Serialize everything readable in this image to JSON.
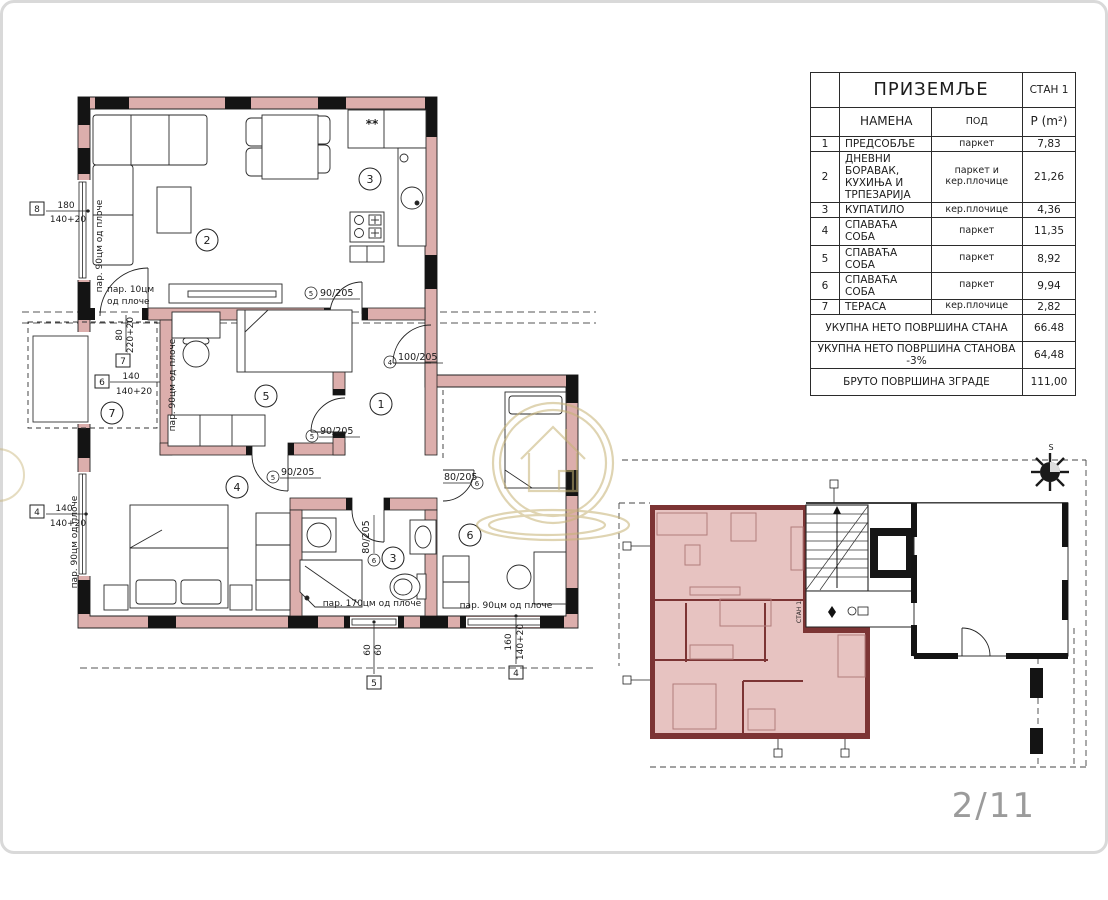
{
  "page": {
    "number": "2/11"
  },
  "table": {
    "title": "ПРИЗЕМЉЕ",
    "unit": "СТАН 1",
    "col_name": "НАМЕНА",
    "col_floor": "ПОД",
    "col_area": "Р (m²)",
    "rows": [
      {
        "num": "1",
        "name": "ПРЕДСОБЉЕ",
        "floor": "паркет",
        "area": "7,83"
      },
      {
        "num": "2",
        "name": "ДНЕВНИ БОРАВАК, КУХИЊА И ТРПЕЗАРИЈА",
        "floor": "паркет и кер.плочице",
        "area": "21,26"
      },
      {
        "num": "3",
        "name": "КУПАТИЛО",
        "floor": "кер.плочице",
        "area": "4,36"
      },
      {
        "num": "4",
        "name": "СПАВАЋА СОБА",
        "floor": "паркет",
        "area": "11,35"
      },
      {
        "num": "5",
        "name": "СПАВАЋА СОБА",
        "floor": "паркет",
        "area": "8,92"
      },
      {
        "num": "6",
        "name": "СПАВАЋА СОБА",
        "floor": "паркет",
        "area": "9,94"
      },
      {
        "num": "7",
        "name": "ТЕРАСА",
        "floor": "кер.плочице",
        "area": "2,82"
      }
    ],
    "summary": [
      {
        "label": "УКУПНА НЕТО ПОВРШИНА СТАНА",
        "value": "66.48"
      },
      {
        "label": "УКУПНА НЕТО ПОВРШИНА СТАНОВА -3%",
        "value": "64,48"
      },
      {
        "label": "БРУТО ПОВРШИНА ЗГРАДЕ",
        "value": "111,00"
      }
    ]
  },
  "floor_plan": {
    "rooms": [
      "1",
      "2",
      "3",
      "3",
      "4",
      "5",
      "6",
      "7"
    ],
    "doors": [
      {
        "size": "90/205",
        "mark": "5"
      },
      {
        "size": "100/205",
        "mark": "4"
      },
      {
        "size": "90/205",
        "mark": "5"
      },
      {
        "size": "90/205",
        "mark": "5"
      },
      {
        "size": "80/205",
        "mark": "6"
      },
      {
        "size": "80/205",
        "mark": "6"
      }
    ],
    "dims": [
      {
        "id": "8",
        "a": "180",
        "b": "140+20"
      },
      {
        "id": "7",
        "a": "80",
        "b": "220+20"
      },
      {
        "id": "6",
        "a": "140",
        "b": "140+20"
      },
      {
        "id": "4",
        "a": "140",
        "b": "140+20"
      },
      {
        "id": "5",
        "a": "60",
        "b": "60"
      },
      {
        "id": "4",
        "a": "160",
        "b": "140+20"
      }
    ],
    "parapets": [
      "пар. 90цм од плоче",
      "пар. 10цм",
      "од плоче",
      "пар. 90цм од плоче",
      "пар. 90цм од плоче",
      "пар. 170цм од плоче",
      "пар. 90цм од плоче"
    ],
    "kitchen_note": "**"
  },
  "site_plan": {
    "unit_label": "СТАН 1"
  },
  "compass": {
    "north": "S"
  },
  "colors": {
    "wall_pink": "#dcaeac",
    "site_wall_red": "#7c3434",
    "site_room_pink": "#e7c3c1",
    "watermark_gold": "#c6b274",
    "page_number_gray": "#9b9b9b"
  }
}
